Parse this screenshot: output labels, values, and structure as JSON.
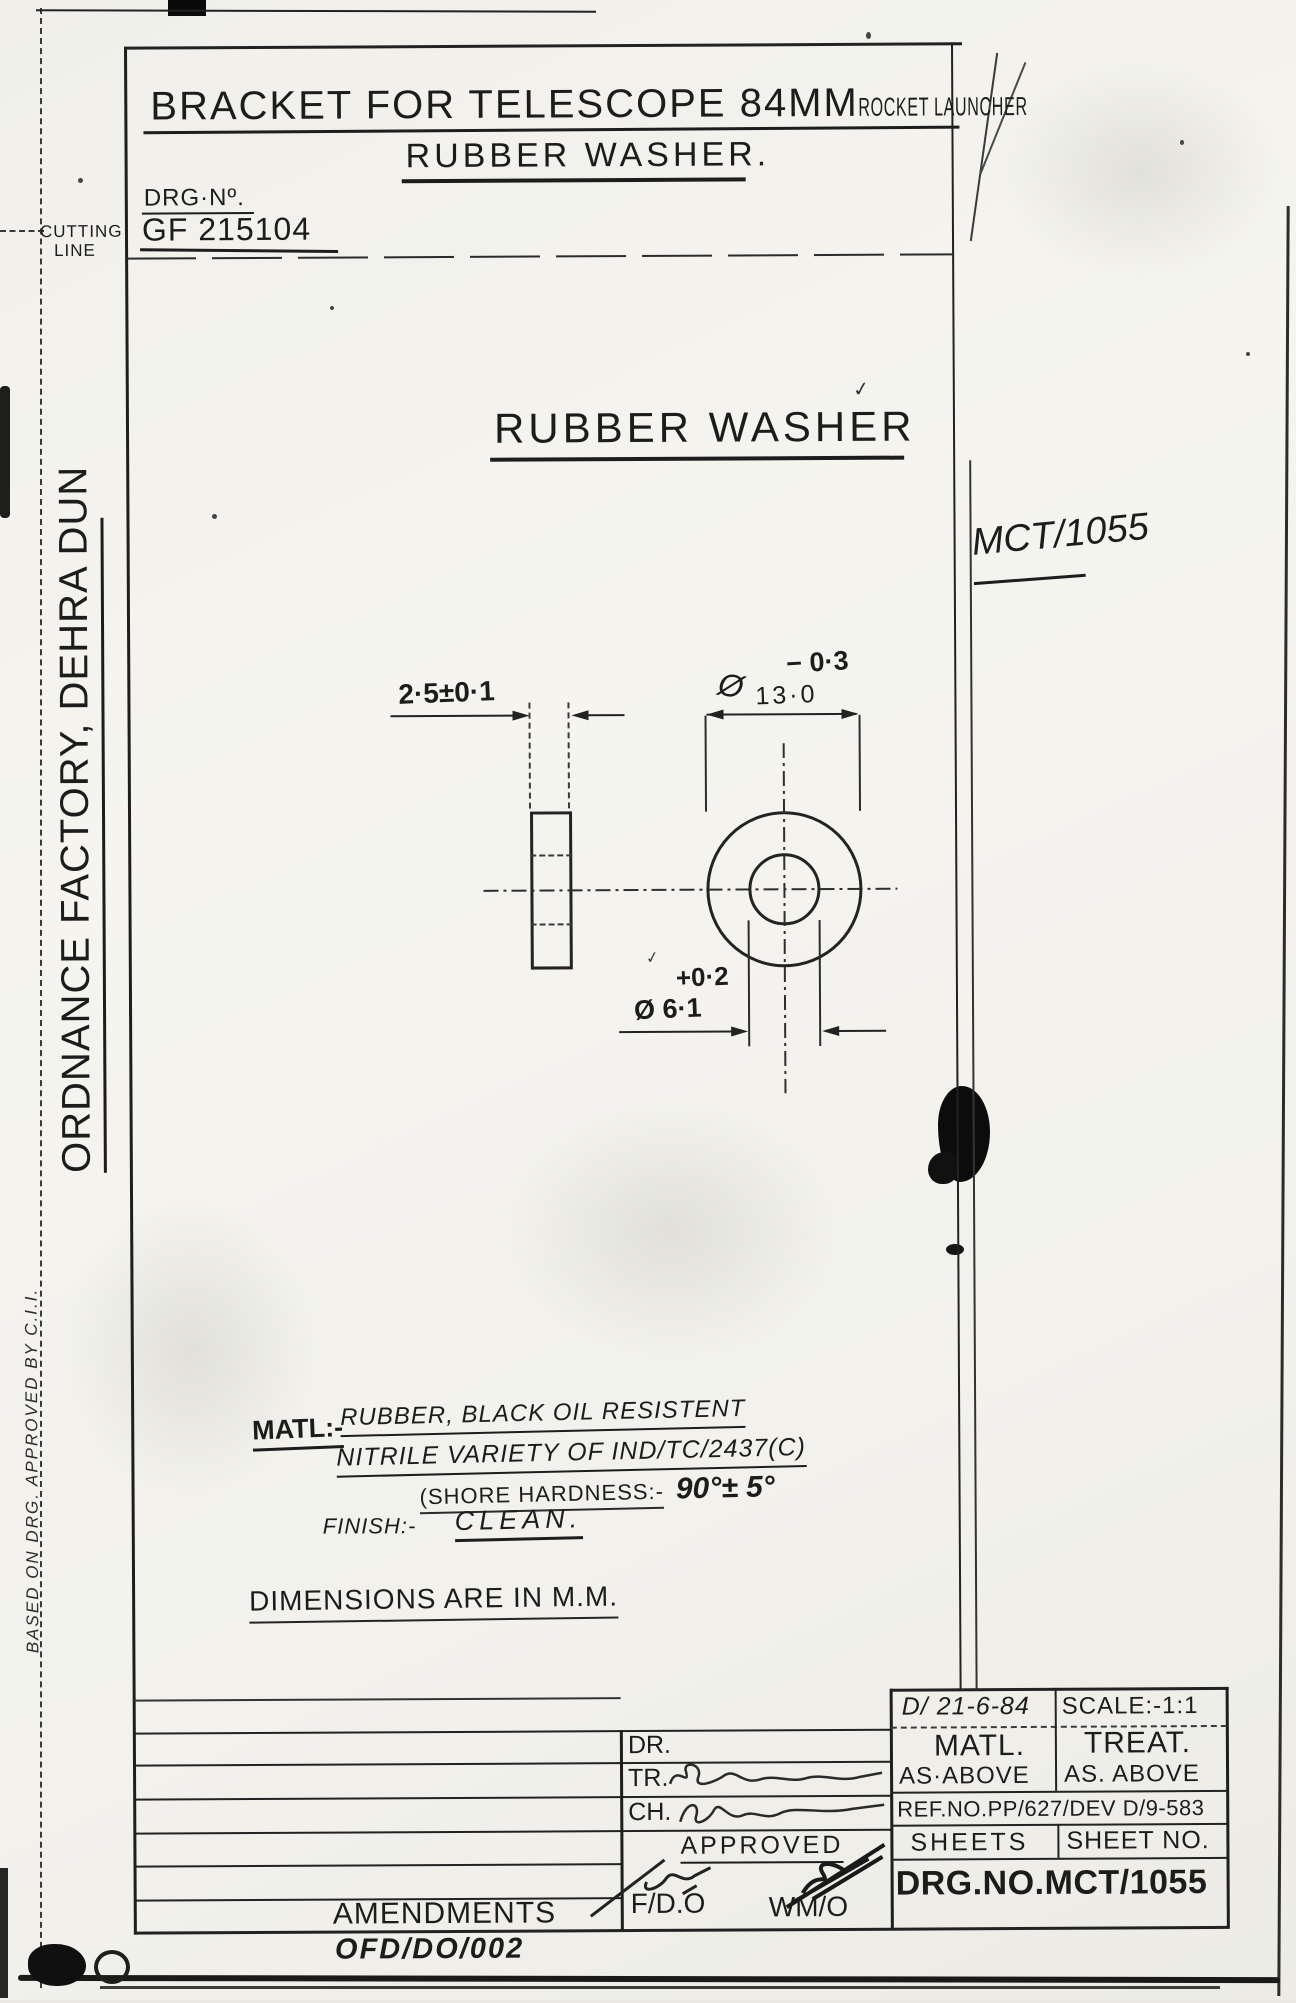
{
  "titles": {
    "main_title_1": "BRACKET FOR TELESCOPE 84MM",
    "main_title_2": "ROCKET LAUNCHER",
    "subtitle": "RUBBER WASHER.",
    "drg_label": "DRG·Nº.",
    "drg_value": "GF 215104",
    "view_title": "RUBBER WASHER",
    "ref_code": "MCT/1055"
  },
  "margin": {
    "cutting_1": "CUTTING",
    "cutting_2": "LINE",
    "factory": "ORDNANCE FACTORY, DEHRA DUN",
    "based_on": "BASED ON DRG. APPROVED BY C.I.I."
  },
  "dims": {
    "thickness": "2·5±0·1",
    "outer_phi": "Ø",
    "outer_dia": "13·0",
    "outer_tol": "− 0·3",
    "inner_tol": "+0·2",
    "inner_dia": "Ø 6·1"
  },
  "notes": {
    "matl_label": "MATL:-",
    "matl_line1": "RUBBER, BLACK OIL RESISTENT",
    "matl_line2": "NITRILE VARIETY OF IND/TC/2437(C)",
    "shore_label": "(SHORE HARDNESS:-",
    "shore_value": "90°± 5°",
    "finish_label": "FINISH:-",
    "finish_value": "CLEAN.",
    "units_note": "DIMENSIONS ARE IN M.M."
  },
  "tblock": {
    "date": "D/ 21-6-84",
    "scale": "SCALE:-1:1",
    "matl_label": "MATL.",
    "matl_value": "AS·ABOVE",
    "treat_label": "TREAT.",
    "treat_value": "AS. ABOVE",
    "ref_no": "REF.NO.PP/627/DEV D/9-583",
    "sheets_label": "SHEETS",
    "sheet_no_label": "SHEET NO.",
    "drg_no": "DRG.NO.MCT/1055",
    "dr": "DR.",
    "tr": "TR.",
    "ch": "CH.",
    "approved": "APPROVED",
    "fdo": "F/D.O",
    "wmo": "WM/O",
    "amendments": "AMENDMENTS",
    "form_no": "OFD/DO/002"
  },
  "marks": {
    "check": "✓"
  },
  "colors": {
    "ink": "#1c1c1c",
    "paper": "#f2f1ec"
  }
}
